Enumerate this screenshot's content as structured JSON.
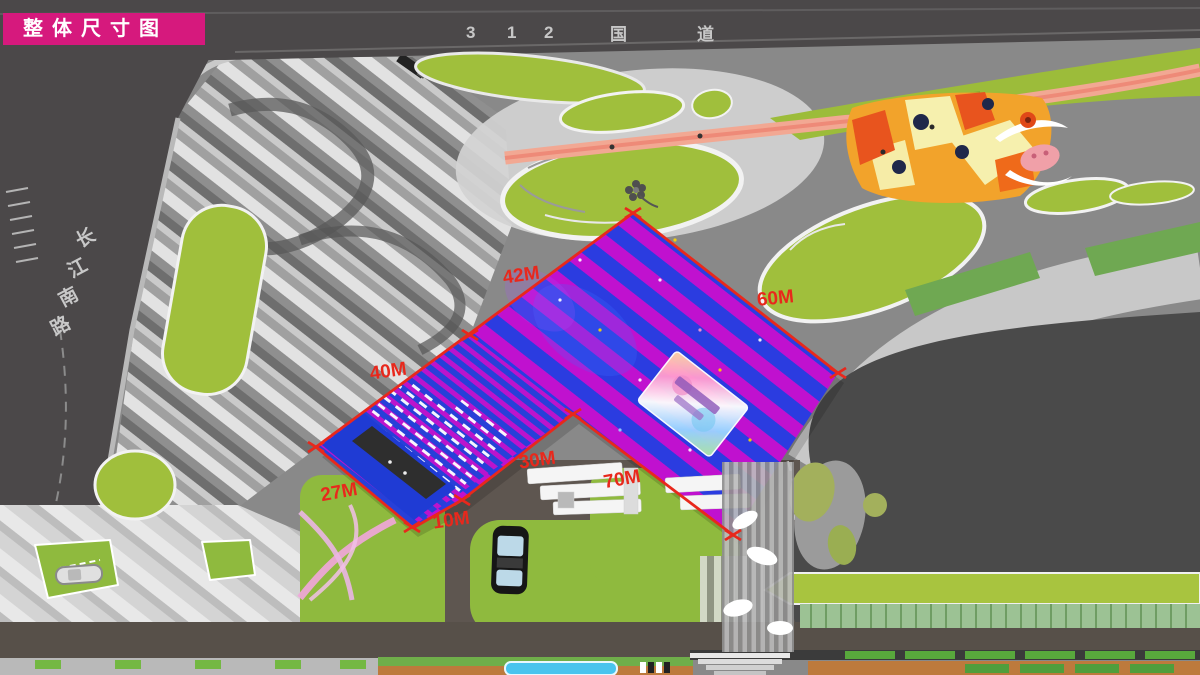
{
  "page": {
    "title_badge": "整体尺寸图"
  },
  "roads": {
    "top": {
      "name": "312 国道",
      "chars": [
        "3",
        "1",
        "2",
        "国",
        "道"
      ]
    },
    "left": {
      "name": "长江南路",
      "chars": [
        "长",
        "江",
        "南",
        "路"
      ]
    }
  },
  "dimensions": [
    {
      "label": "42M"
    },
    {
      "label": "60M"
    },
    {
      "label": "40M"
    },
    {
      "label": "30M"
    },
    {
      "label": "70M"
    },
    {
      "label": "27M"
    },
    {
      "label": "10M"
    }
  ],
  "colors": {
    "badge_magenta": "#d6197d",
    "dimension_red": "#e8281c",
    "roof_blue": "#2b3ce0",
    "roof_magenta": "#c011cf",
    "site_green": "#a0bf3c",
    "plaza_orange": "#f2a32b",
    "track_pink": "#f2a893"
  },
  "icons": {
    "flower": "flower-icon",
    "bull_mural": "bull-mural-icon",
    "roof_billboard": "roof-billboard-icon",
    "bus": "bus-icon",
    "car": "car-icon"
  }
}
